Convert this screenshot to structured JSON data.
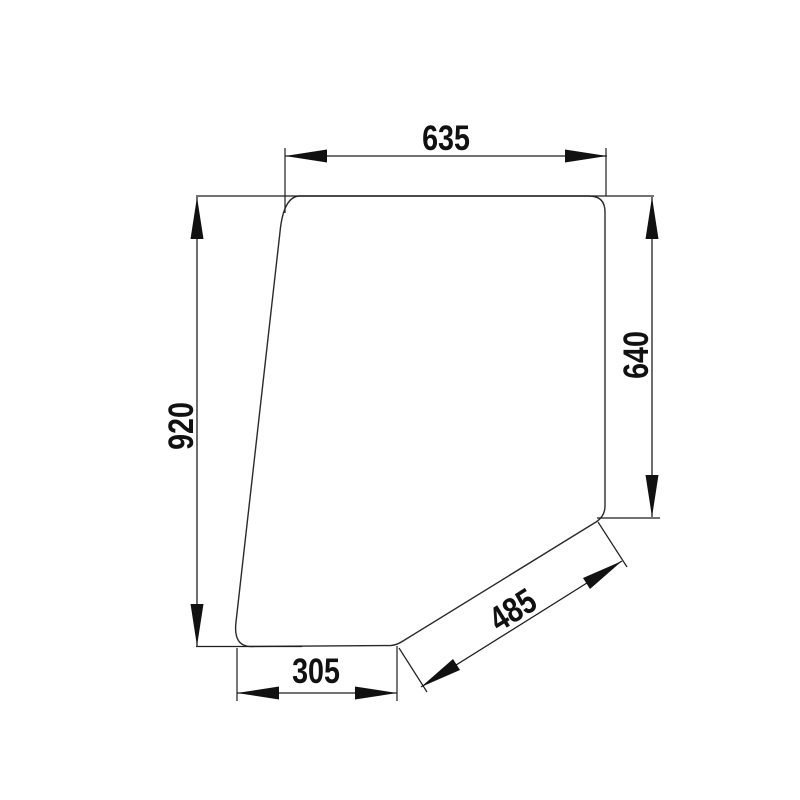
{
  "drawing": {
    "title": "Glass panel technical dimension drawing",
    "background_color": "#ffffff",
    "line_color": "#1f1f1f",
    "dimensions": {
      "top_width": "635",
      "left_height": "920",
      "right_height": "640",
      "bottom_width": "305",
      "diagonal_length": "485"
    }
  }
}
